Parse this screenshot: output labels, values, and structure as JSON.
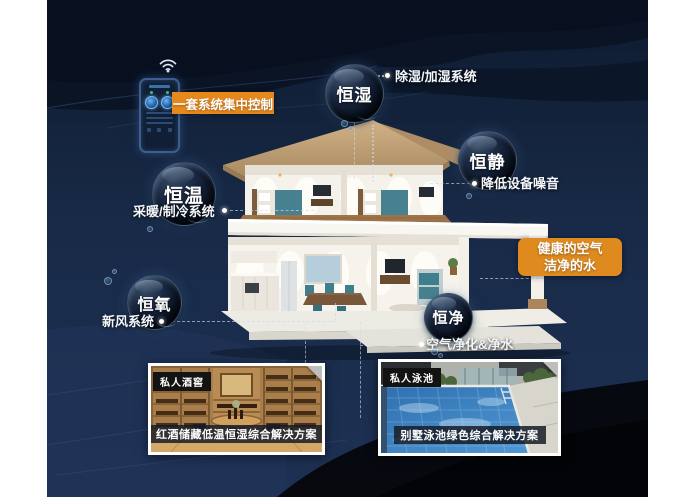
{
  "control": {
    "label": "一套系统集中控制"
  },
  "features": [
    {
      "key": "humidity",
      "bubble": "恒湿",
      "system": "除湿/加湿系统"
    },
    {
      "key": "quiet",
      "bubble": "恒静",
      "system": "降低设备噪音"
    },
    {
      "key": "temperature",
      "bubble": "恒温",
      "system": "采暖/制冷系统"
    },
    {
      "key": "oxygen",
      "bubble": "恒氧",
      "system": "新风系统"
    },
    {
      "key": "purity",
      "bubble": "恒净",
      "system": "空气净化&净水"
    }
  ],
  "callout": {
    "line1": "健康的空气",
    "line2": "洁净的水"
  },
  "cards": [
    {
      "tag": "私人酒窖",
      "caption": "红酒储藏低温恒湿综合解决方案",
      "scene": "wine-cellar-photo"
    },
    {
      "tag": "私人泳池",
      "caption": "别墅泳池绿色综合解决方案",
      "scene": "pool-photo"
    }
  ],
  "icons": {
    "wifi": "wifi-icon",
    "device": "control-panel-icon",
    "dials": "thermostat-dial-icon"
  },
  "colors": {
    "accent_orange": "#E6891D",
    "background_navy": "#152540",
    "bubble_rim": "#8FC0E8",
    "text_white": "#FFFFFF"
  }
}
